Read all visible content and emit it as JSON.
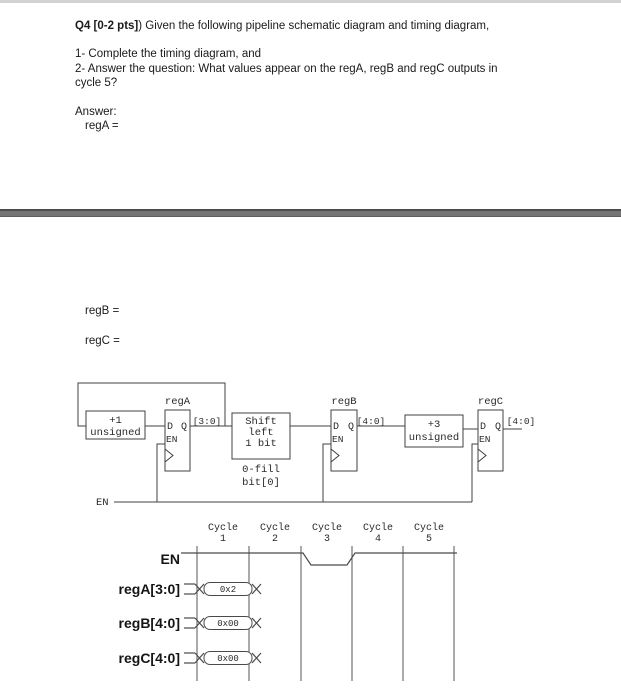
{
  "page1": {
    "q_bold": "Q4 [0-2 pts]",
    "q_rest": ") Given the following pipeline schematic diagram and timing diagram,",
    "item1": "1- Complete the timing diagram, and",
    "item2_line1": "2- Answer the question: What values appear on the regA, regB and regC outputs in",
    "item2_line2": "cycle 5?",
    "answer_label": "Answer:",
    "rega_answer": "regA ="
  },
  "page2": {
    "regb_answer": "regB =",
    "regc_answer": "regC ="
  },
  "schematic": {
    "en_net_label": "EN",
    "blocks": {
      "inc": {
        "line1": "+1",
        "line2": "unsigned"
      },
      "shift": {
        "line1": "Shift",
        "line2": "left",
        "line3": "1 bit",
        "note1": "0-fill",
        "note2": "bit[0]"
      },
      "add3": {
        "line1": "+3",
        "line2": "unsigned"
      }
    },
    "registers": {
      "rega": {
        "title": "regA",
        "d": "D",
        "q": "Q",
        "en": "EN",
        "bus": "[3:0]"
      },
      "regb": {
        "title": "regB",
        "d": "D",
        "q": "Q",
        "en": "EN",
        "bus": "[4:0]"
      },
      "regc": {
        "title": "regC",
        "d": "D",
        "q": "Q",
        "en": "EN",
        "bus": "[4:0]"
      }
    }
  },
  "timing": {
    "cycles": [
      {
        "word": "Cycle",
        "num": "1"
      },
      {
        "word": "Cycle",
        "num": "2"
      },
      {
        "word": "Cycle",
        "num": "3"
      },
      {
        "word": "Cycle",
        "num": "4"
      },
      {
        "word": "Cycle",
        "num": "5"
      }
    ],
    "signals": [
      {
        "label": "EN",
        "type": "waveform",
        "description": "high in cycles 1-2, low in cycle 3, high in cycles 4-5"
      },
      {
        "label": "regA[3:0]",
        "type": "bus",
        "cycle1_value": "0x2"
      },
      {
        "label": "regB[4:0]",
        "type": "bus",
        "cycle1_value": "0x00"
      },
      {
        "label": "regC[4:0]",
        "type": "bus",
        "cycle1_value": "0x00"
      }
    ]
  },
  "colors": {
    "divider": "#747474",
    "schematic_line": "#404040",
    "timing_line": "#4a4a4a",
    "text": "#1a1a1a"
  }
}
